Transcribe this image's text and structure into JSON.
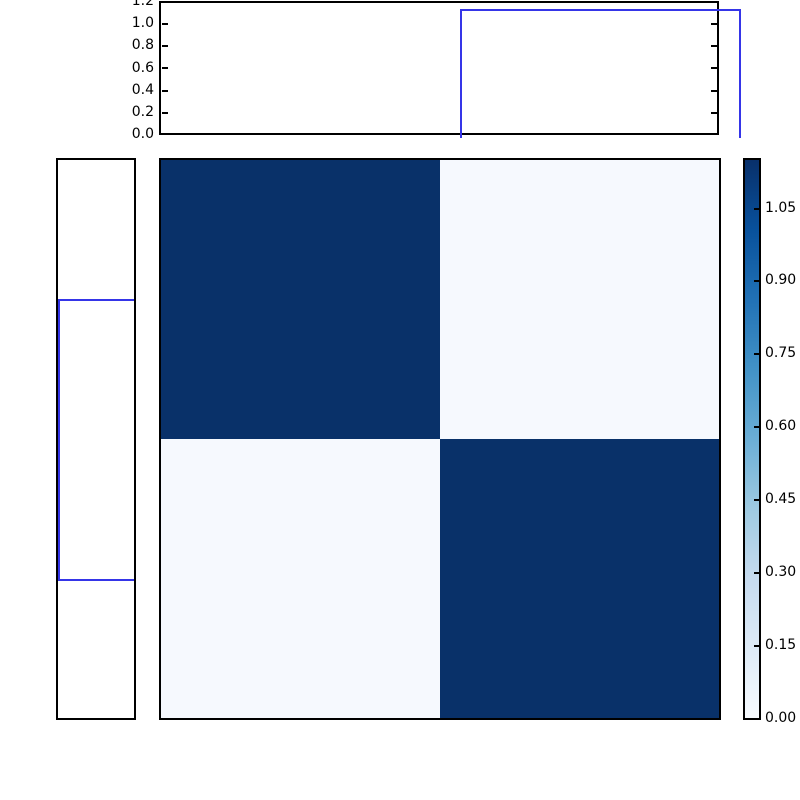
{
  "figure": {
    "background": "#ffffff",
    "line_color": "#3535e8",
    "border_color": "#000000",
    "dark_cell_color": "#093169",
    "light_cell_color": "#f6f9fe"
  },
  "top_panel": {
    "yticks": [
      "1.2",
      "1.0",
      "0.8",
      "0.6",
      "0.4",
      "0.2",
      "0.0"
    ]
  },
  "colorbar": {
    "ticks": [
      "1.05",
      "0.90",
      "0.75",
      "0.60",
      "0.45",
      "0.30",
      "0.15",
      "0.00"
    ],
    "colormap_name": "Blues",
    "gradient_stops": [
      "#f7fbff",
      "#deebf7",
      "#c6dbef",
      "#9ecae1",
      "#6baed6",
      "#4292c6",
      "#2171b5",
      "#08519c",
      "#08306b"
    ]
  },
  "chart_data": [
    {
      "type": "line",
      "name": "top-marginal-step",
      "x": [
        0.0,
        0.25,
        0.25,
        0.75,
        0.75,
        1.0
      ],
      "y": [
        0.0,
        0.0,
        1.15,
        1.15,
        0.0,
        0.0
      ],
      "ylim": [
        0.0,
        1.2
      ],
      "yticks": [
        0.0,
        0.2,
        0.4,
        0.6,
        0.8,
        1.0,
        1.2
      ],
      "line_color": "#3535e8",
      "grid": false,
      "legend": "none"
    },
    {
      "type": "line",
      "name": "left-marginal-step-rotated",
      "orientation": "vertical",
      "position": [
        0.0,
        0.25,
        0.25,
        0.75,
        0.75,
        1.0
      ],
      "value": [
        0.0,
        0.0,
        1.15,
        1.15,
        0.0,
        0.0
      ],
      "value_lim": [
        0.0,
        1.2
      ],
      "value_axis_inverted": true,
      "line_color": "#3535e8",
      "grid": false,
      "legend": "none"
    },
    {
      "type": "heatmap",
      "name": "block-matrix",
      "matrix": [
        [
          1.15,
          0.05
        ],
        [
          0.05,
          1.15
        ]
      ],
      "rows": 2,
      "cols": 2,
      "colormap": "Blues",
      "vmin": 0.0,
      "vmax": 1.15,
      "colorbar_ticks": [
        0.0,
        0.15,
        0.3,
        0.45,
        0.6,
        0.75,
        0.9,
        1.05
      ],
      "colorbar_position": "right"
    }
  ]
}
